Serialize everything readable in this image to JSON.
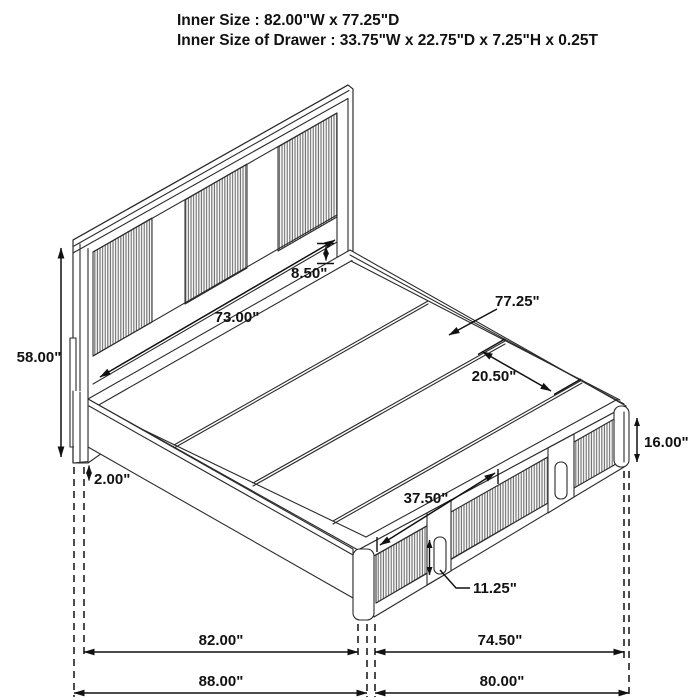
{
  "title": {
    "line1": "Inner Size : 82.00\"W x 77.25\"D",
    "line2": "Inner Size of Drawer : 33.75\"W x 22.75\"D x 7.25\"H x 0.25T"
  },
  "diagram": {
    "type": "isometric-bed-dimension-drawing",
    "subject": "storage platform bed with headboard and footboard drawers",
    "line_color": "#2b2b2b",
    "background": "#ffffff",
    "dimensions": {
      "headboard_inner_width": "73.00\"",
      "headboard_height": "58.00\"",
      "headboard_to_deck_gap": "8.50\"",
      "inner_depth": "77.25\"",
      "slat_panel_width": "20.50\"",
      "footboard_height": "16.00\"",
      "base_clearance": "2.00\"",
      "drawer_front_width": "37.50\"",
      "drawer_handle_height": "11.25\"",
      "inner_width": "82.00\"",
      "footboard_outer_width": "74.50\"",
      "overall_width": "88.00\"",
      "overall_depth": "80.00\""
    }
  }
}
